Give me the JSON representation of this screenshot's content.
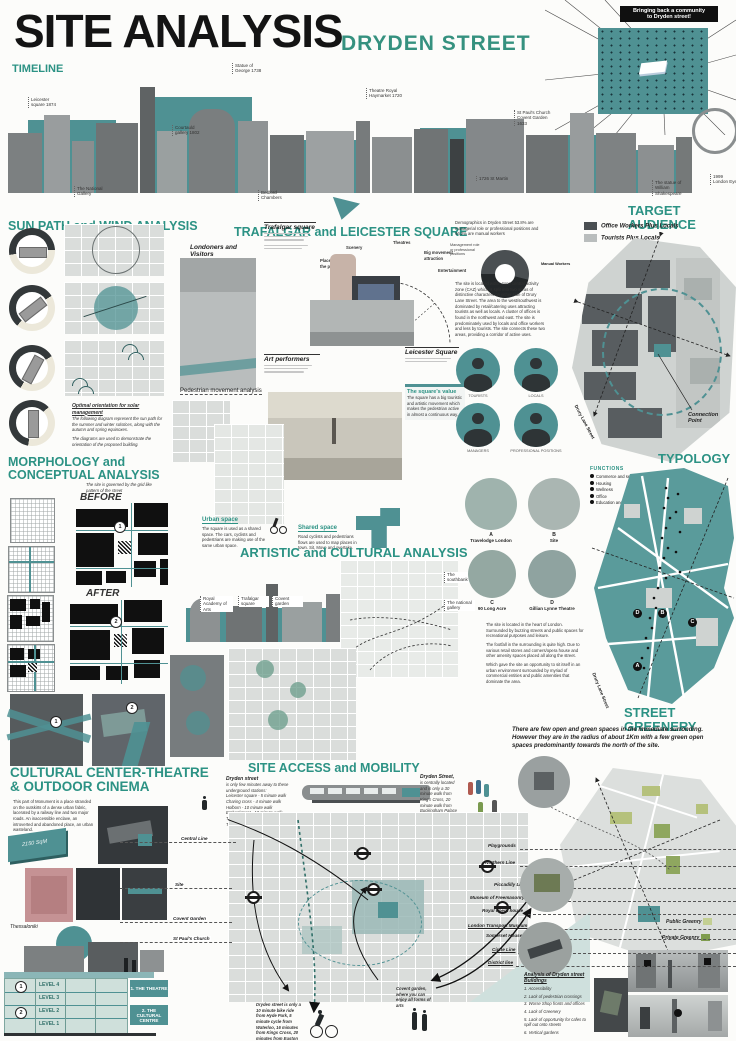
{
  "colors": {
    "accent_teal": "#4f9193",
    "heading_teal": "#2c9284",
    "public_green": "#c3cf92",
    "private_green": "#7f9c4f"
  },
  "header": {
    "title": "SITE ANALYSIS",
    "subtitle": "DRYDEN STREET"
  },
  "community": {
    "line1": "Bringing back a community",
    "line2": "to Dryden street!"
  },
  "timeline": {
    "heading": "TIMELINE",
    "labels": [
      "Leicester square 1874",
      "The National Gallery",
      "Courtauld gallery 1802",
      "Statue of George 1738",
      "Bedford Chambers",
      "Theatre Royal Haymarket 1720",
      "1726 St Martin",
      "St Paul's Church Covent Garden 1633",
      "The statue of William Shakespeare",
      "1999 London Eye"
    ]
  },
  "sun": {
    "heading": "SUN PATH and WIND ANALYSIS",
    "caption_title": "Optimal orientation for solar management",
    "caption_1": "The following diagram represent the sun path for the summer and winter solstices, along with the autumn and spring equinoxes.",
    "caption_2": "The diagrams are used to demonstrate the orientation of the proposed building."
  },
  "trafalgar": {
    "heading": "TRAFALGAR and LEICESTER SQUARE",
    "londoners": "Londoners and Visitors",
    "trafalgar_sq": "Trafalgar square",
    "art": "Art performers",
    "leicester": "Leicester Square",
    "square_value_title": "The square's value",
    "square_value_text": "The square has a big touristic and artistic movement which makes the pedestrian active in almost a continuous way.",
    "pedestrian": "Pedestrian movement analysis",
    "arc_labels": [
      "Place for the public",
      "Scenery",
      "Theatres",
      "Big movement attraction",
      "Entertainment"
    ]
  },
  "demographics": {
    "intro": "Demographics in Dryden Street 53.8% are managerial role or professional positions and 46.2% are manual workers",
    "label_management": "Management role or professional positions",
    "label_manual": "Manual Workers",
    "caz_text": "The site is located within zone central activity zone (CAZ) which is split into two areas of distinctive characters on either side of Drury Lane Street. The area to the west/southwest is dominated by retail/catering uses attracting tourists as well as locals. A cluster of offices is found in the northwest and east. The site is predominately used by locals and office workers and less by tourists. The site connects these two areas, providing a corridor of active uses.",
    "people": [
      "TOURISTS",
      "LOCALS",
      "MANAGERS",
      "PROFESSIONAL POSITIONS"
    ],
    "chart": {
      "type": "pie",
      "labels": [
        "Managerial / professional positions",
        "Manual workers"
      ],
      "values": [
        53.8,
        46.2
      ]
    }
  },
  "target": {
    "heading": "TARGET AUDIENCE",
    "legend": [
      "Office Workers Plus Locals",
      "Tourists Plus Locals"
    ],
    "connection": "Connection Point",
    "street": "Drury Lane Street"
  },
  "morphology": {
    "heading_1": "MORPHOLOGY and",
    "heading_2": "CONCEPTUAL ANALYSIS",
    "grid_note": "The site is governed by the grid like pattern of the street",
    "before": "BEFORE",
    "after": "AFTER",
    "n1": "1",
    "n2": "2"
  },
  "artistic": {
    "heading": "ARTISTIC and CULTURAL ANALYSIS",
    "urban_title": "Urban space",
    "urban_text": "The square is used as a shared space. The cars, cyclists and pedestrians are making use of the same urban space.",
    "shared_title": "Shared space",
    "shared_text": "Road cyclists and pedestrians flows are used to map places in town. Sit, Move and overtake.",
    "landmarks": [
      "Royal Academy of Arts",
      "Trafalgar square",
      "Covent garden",
      "The southbank",
      "The national gallery"
    ],
    "circles": [
      {
        "letter": "A",
        "label": "Travelodge London"
      },
      {
        "letter": "B",
        "label": "Site"
      },
      {
        "letter": "C",
        "label": "90 Long Acre"
      },
      {
        "letter": "D",
        "label": "Gillian Lynne Theatre"
      }
    ],
    "site_text_1": "The site is located in the heart of London. Surrounded by buzzing streets and public spaces for recreational purposes and leisure.",
    "site_text_2": "The footfall in the surrounding is quite high. Due to various retail stores and corners/opera house and other amenity spaces placed all along the street.",
    "site_text_3": "Which gave the site an opportunity to sit itself in an urban environment surrounded by myriad of commercial entities and public amenities that dominate the area."
  },
  "typology": {
    "heading": "TYPOLOGY",
    "functions_title": "FUNCTIONS",
    "functions": [
      "Commerce and services",
      "Housing",
      "Wellness",
      "Office",
      "Education and Culture"
    ],
    "street": "Drury Lane Street",
    "markers": [
      "A",
      "B",
      "C",
      "D"
    ]
  },
  "greenery": {
    "heading": "STREET GREENERY",
    "text": "There are few open and green spaces in the immediate surronding. However they are in the radius of about 1Km with a few green open spaces predominantly towards the north of the site.",
    "legend_public": "Public Greenry",
    "legend_private": "Private Greenry"
  },
  "cultural": {
    "heading_1": "CULTURAL CENTER-THEATRE",
    "heading_2": "& OUTDOOR CINEMA",
    "text": "This part of Monument is a place stranded on the outskirts of a dense urban fabric, lacerated by a railway line and two major roads. An inaccessible enclave, an introverted and abandoned place, an urban wasteland.",
    "area": "2150 SqM",
    "city": "Thessaloniki",
    "levels": [
      "LEVEL 4",
      "LEVEL 3",
      "LEVEL 2",
      "LEVEL 1"
    ],
    "n1": "1",
    "n2": "2",
    "theatre": "1. THE THEATRE",
    "centre": "2. THE CULTURAL CENTRE"
  },
  "mobility": {
    "heading": "SITE ACCESS and MOBILITY",
    "stations_intro_1": "Dryden street",
    "stations_intro_2": "is only few minutes away to these underground stations:",
    "stations": [
      "Leicester square - 5 minute walk",
      "Charing cross - 4 minute walk",
      "Holborn - 10 minute walk",
      "Embankment - 10 minute walk",
      "Temple - 11 minute walk",
      "Tottenham court road - 12 minute walk"
    ],
    "dryden_bold": "Dryden Street,",
    "dryden_text": "is centrally located and is only a 30 minute walk from King's Cross, 20 minute walk from Buckingham Palace and a 10 minute walk from Piccadilly Circus.",
    "left_labels": [
      "Central Line",
      "Site",
      "Covent Garden",
      "St Paul's Church"
    ],
    "right_labels": [
      "Playgrounds",
      "Northern Line",
      "Piccadilly Line",
      "Museum of Freemasonry",
      "Royal opera house",
      "London Transport Museum",
      "Somerset House",
      "Circle Line",
      "District line"
    ],
    "bike_text": "Dryden street is only a 10 minute bike ride from Hyde Park, 5 minute cycle from Waterloo, 16 minutes from Kings Cross, 20 minutes from Euston Square",
    "covent_note": "Covent garden, where you can enjoy all forms of arts"
  },
  "analysis": {
    "title": "Analysis of Dryden street Buildings",
    "items": [
      "1. Accessibility",
      "2. Lack of pedestrian crossings",
      "3. Worse Shop fronts and offices",
      "4. Lack of Greenery",
      "5. Lack of opportunity for cafes to spill out onto streets",
      "6. Vertical gardens"
    ]
  }
}
